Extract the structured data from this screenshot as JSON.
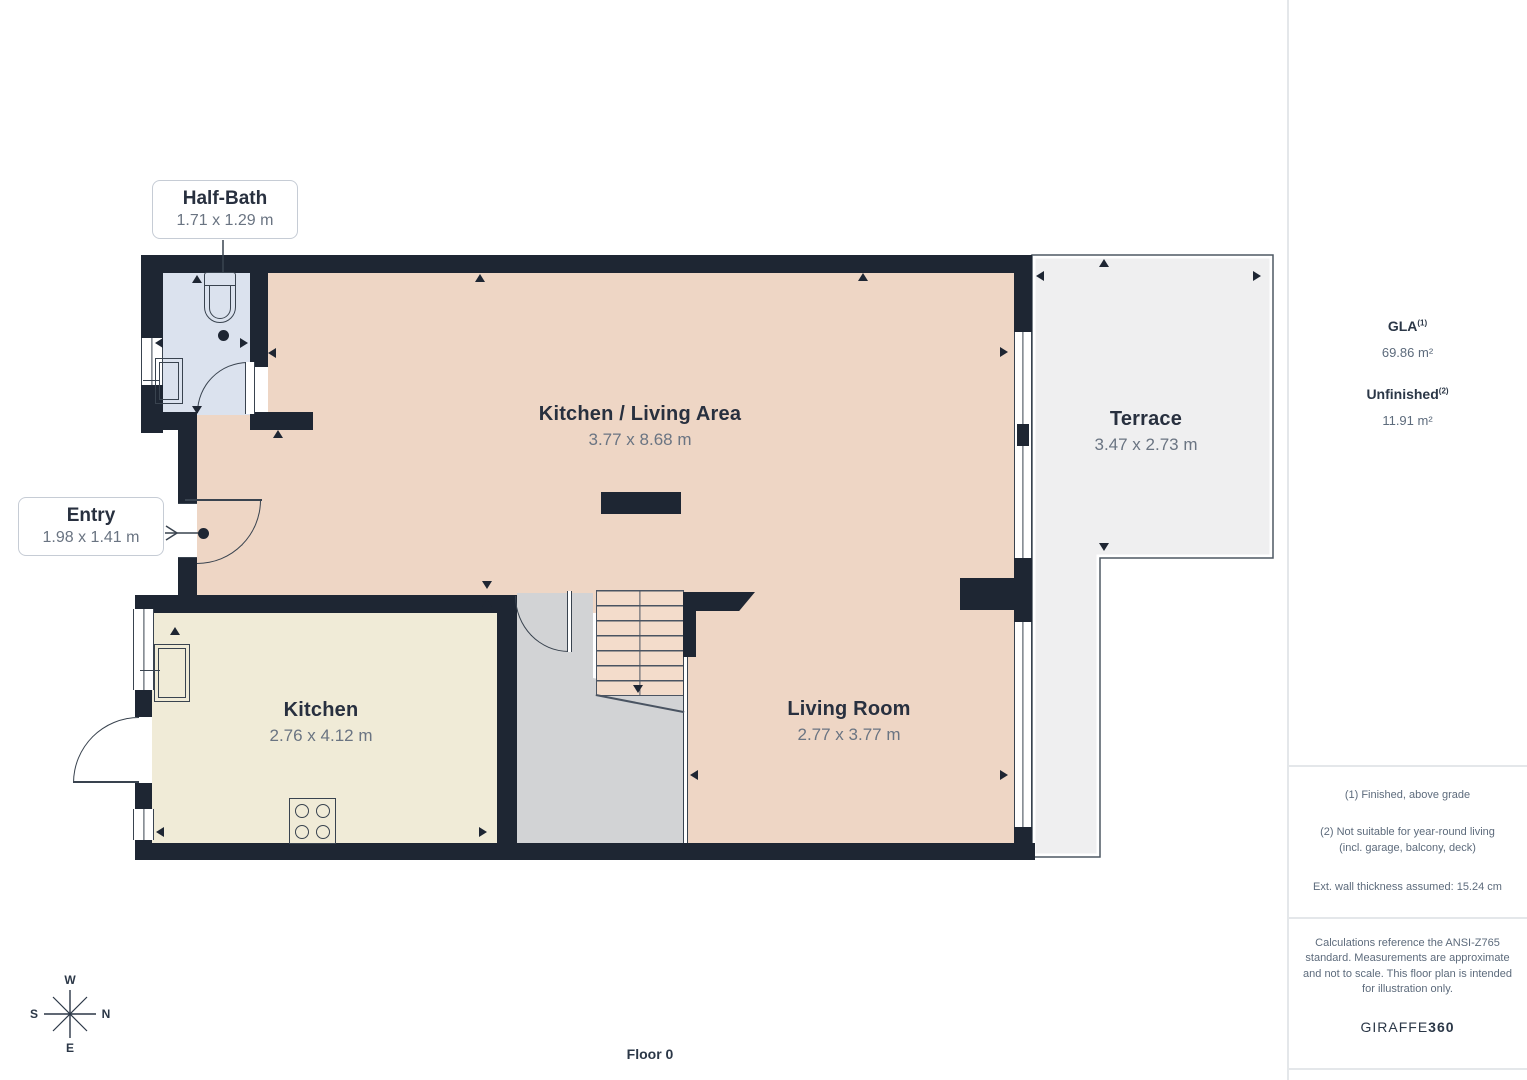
{
  "floor_plan": {
    "floor_label": "Floor 0",
    "compass": {
      "top": "W",
      "right": "N",
      "left": "S",
      "bottom": "E"
    },
    "rooms": {
      "kitchen_living": {
        "name": "Kitchen / Living Area",
        "dims": "3.77 x 8.68 m"
      },
      "terrace": {
        "name": "Terrace",
        "dims": "3.47 x 2.73 m"
      },
      "kitchen": {
        "name": "Kitchen",
        "dims": "2.76 x 4.12 m"
      },
      "living_room": {
        "name": "Living Room",
        "dims": "2.77 x 3.77 m"
      },
      "half_bath": {
        "name": "Half-Bath",
        "dims": "1.71 x 1.29 m"
      },
      "entry": {
        "name": "Entry",
        "dims": "1.98 x 1.41 m"
      }
    }
  },
  "sidebar": {
    "gla": {
      "label": "GLA",
      "sup": "(1)",
      "value": "69.86 m²"
    },
    "unfinished": {
      "label": "Unfinished",
      "sup": "(2)",
      "value": "11.91 m²"
    },
    "footnotes": [
      "(1) Finished, above grade",
      "(2) Not suitable for year-round living",
      "(incl. garage, balcony, deck)",
      "Ext. wall thickness assumed: 15.24 cm"
    ],
    "disclaimer": "Calculations reference the ANSI-Z765 standard. Measurements are approximate and not to scale. This floor plan is intended for illustration only.",
    "brand": {
      "name": "GIRAFFE",
      "suffix": "360"
    }
  },
  "colors": {
    "wall": "#1e2633",
    "room_salmon": "#eed6c5",
    "room_cream": "#f0ebd7",
    "room_blue": "#dbe2ee",
    "hall_gray": "#d2d3d5",
    "terrace_gray": "#efeff0",
    "title_text": "#28303f",
    "dims_text": "#6a7482",
    "note_text": "#5d6b7c"
  }
}
